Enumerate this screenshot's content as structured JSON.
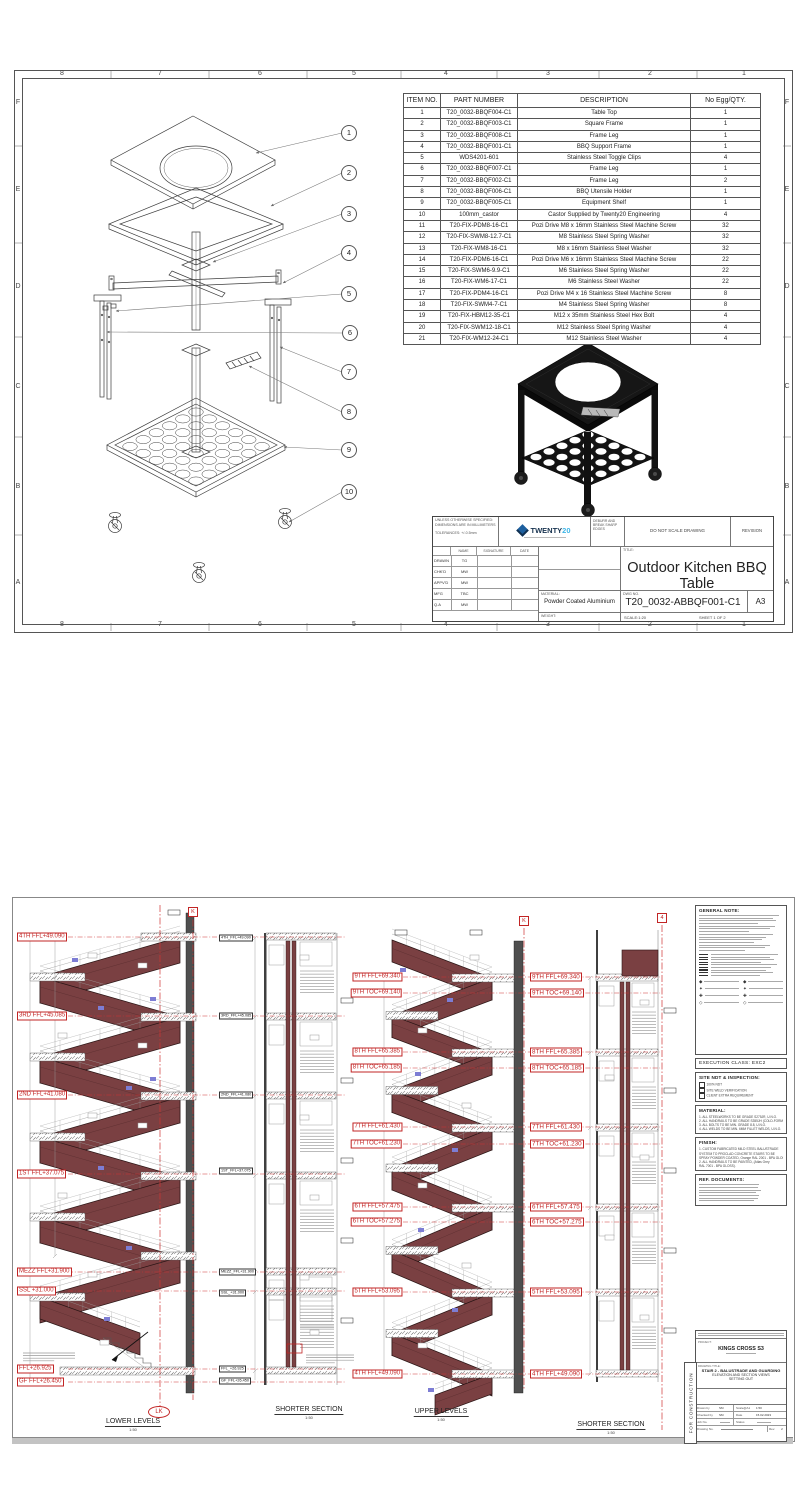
{
  "sheet1": {
    "grid": {
      "cols": [
        "8",
        "7",
        "6",
        "5",
        "4",
        "3",
        "2",
        "1"
      ],
      "rows": [
        "F",
        "E",
        "D",
        "C",
        "B",
        "A"
      ]
    },
    "balloons": [
      "1",
      "2",
      "3",
      "4",
      "5",
      "6",
      "7",
      "8",
      "9",
      "10"
    ],
    "parts_table": {
      "headers": [
        "ITEM NO.",
        "PART NUMBER",
        "DESCRIPTION",
        "No Egg/QTY."
      ],
      "rows": [
        [
          "1",
          "T20_0032-BBQF004-C1",
          "Table Top",
          "1"
        ],
        [
          "2",
          "T20_0032-BBQF003-C1",
          "Square Frame",
          "1"
        ],
        [
          "3",
          "T20_0032-BBQF008-C1",
          "Frame Leg",
          "1"
        ],
        [
          "4",
          "T20_0032-BBQF001-C1",
          "BBQ Support Frame",
          "1"
        ],
        [
          "5",
          "WDS4201-601",
          "Stainless Steel Toggle Clips",
          "4"
        ],
        [
          "6",
          "T20_0032-BBQF007-C1",
          "Frame Leg",
          "1"
        ],
        [
          "7",
          "T20_0032-BBQF002-C1",
          "Frame Leg",
          "2"
        ],
        [
          "8",
          "T20_0032-BBQF006-C1",
          "BBQ Utensile Holder",
          "1"
        ],
        [
          "9",
          "T20_0032-BBQF005-C1",
          "Equipment Shelf",
          "1"
        ],
        [
          "10",
          "100mm_castor",
          "Castor Supplied by Twenty20 Engineering",
          "4"
        ],
        [
          "11",
          "T20-FIX-PDM8-16-C1",
          "Pozi Drive M8 x 16mm Stainless Steel Machine Screw",
          "32"
        ],
        [
          "12",
          "T20-FIX-SWM8-12.7-C1",
          "M8 Stainless Steel Spring Washer",
          "32"
        ],
        [
          "13",
          "T20-FIX-WM8-16-C1",
          "M8 x 16mm Stainless Steel Washer",
          "32"
        ],
        [
          "14",
          "T20-FIX-PDM6-16-C1",
          "Pozi Drive M6 x 16mm Stainless Steel Machine Screw",
          "22"
        ],
        [
          "15",
          "T20-FIX-SWM6-9.9-C1",
          "M6 Stainless Steel Spring Washer",
          "22"
        ],
        [
          "16",
          "T20-FIX-WM6-17-C1",
          "M6 Stainless Steel Washer",
          "22"
        ],
        [
          "17",
          "T20-FIX-PDM4-16-C1",
          "Pozi Drive M4 x 16 Stainless Steel Machine Screw",
          "8"
        ],
        [
          "18",
          "T20-FIX-SWM4-7-C1",
          "M4 Stainless Steel Spring Washer",
          "8"
        ],
        [
          "19",
          "T20-FIX-HBM12-35-C1",
          "M12 x 35mm Stainless Steel Hex Bolt",
          "4"
        ],
        [
          "20",
          "T20-FIX-SWM12-18-C1",
          "M12 Stainless Steel Spring Washer",
          "4"
        ],
        [
          "21",
          "T20-FIX-WM12-24-C1",
          "M12 Stainless Steel Washer",
          "4"
        ]
      ]
    },
    "title_block": {
      "tol1": "UNLESS OTHERWISE SPECIFIED:",
      "tol2": "DIMENSIONS ARE IN MILLIMETERS",
      "tol3": "TOLERANCES: +/-0.5mm",
      "logo_a": "TWENTY",
      "logo_b": "20",
      "deburr": "DEBURR AND BREAK SHARP EDGES",
      "do_not_scale": "DO NOT SCALE DRAWING",
      "revision": "REVISION",
      "sign_headers": [
        "NAME",
        "SIGNATURE",
        "DATE"
      ],
      "sign_rows": [
        [
          "DRAWN",
          "TG"
        ],
        [
          "CHK'D",
          "MW"
        ],
        [
          "APPV'D",
          "MW"
        ],
        [
          "MFG",
          "TBC"
        ],
        [
          "Q.A",
          "MW"
        ]
      ],
      "material_label": "MATERIAL:",
      "material": "Powder Coated Aluminium",
      "weight_label": "WEIGHT:",
      "title_label": "TITLE:",
      "title1": "Outdoor Kitchen BBQ",
      "title2": "Table",
      "dwg_label": "DWG NO.",
      "dwg_no": "T20_0032-ABBQF001-C1",
      "size": "A3",
      "scale": "SCALE:1:20",
      "sheet": "SHEET 1 OF 2"
    }
  },
  "sheet2": {
    "levels_left": [
      "4TH FFL+49.090",
      "3RD FFL+45.085",
      "2ND FFL+41.080",
      "1ST FFL+37.075",
      "MEZZ FFL+31.900",
      "SSL +31.000",
      "FFL+26.925",
      "GF FFL+26.450"
    ],
    "levels_small": [
      "4TH_FFL+49.090",
      "3RD_FFL+45.085",
      "2ND_FFL+41.080",
      "1ST_FFL+37.075",
      "MEZZ_FFL+31.900",
      "SSL_+31.000",
      "FFL_+26.925",
      "GF_FFL+26.450"
    ],
    "levels_upper": [
      "9TH FFL+69.340",
      "9TH TOC+69.140",
      "8TH FFL+65.385",
      "8TH TOC+65.185",
      "7TH FFL+61.430",
      "7TH TOC+61.230",
      "6TH FFL+57.475",
      "6TH TOC+57.275",
      "5TH FFL+53.095",
      "4TH FFL+49.090"
    ],
    "markers": {
      "k1": "K",
      "k2": "K",
      "four": "4",
      "lk": "LK"
    },
    "section_titles": [
      {
        "label": "LOWER LEVELS",
        "scale": "1:50"
      },
      {
        "label": "SHORTER SECTION",
        "scale": "1:50"
      },
      {
        "label": "UPPER LEVELS",
        "scale": "1:50"
      },
      {
        "label": "SHORTER SECTION",
        "scale": "1:50"
      }
    ],
    "notes": {
      "general_title": "GENERAL NOTE:",
      "execution": "EXECUTION CLASS:  EXC2",
      "ndt_title": "SITE NDT & INSPECTION:",
      "ndt_items": [
        "100% NDT",
        "SITE WELD VERIFICATION",
        "CLIENT EXTRA REQUIREMENT"
      ],
      "material_title": "MATERIAL:",
      "material_items": [
        "1. ALL STEELWORKS TO BE GRADE S275JR, U.N.O.",
        "2. ALL HANDRAILS TO BE GRADE S355JH (COLD-FORMED)",
        "3. ALL BOLTS TO BE MIN. GRADE 8.8, U.N.O.",
        "4. ALL WELDS TO BE MIN. 6MM FILLET WELDS, U.N.O."
      ],
      "finish_title": "FINISH:",
      "finish_items": [
        "1. CUSTOM FABRICATED MILD STEEL BALUSTRADE",
        "SYSTEM TO PROCLAD CONCRETE STAIRS TO BE",
        "SPRAY POWDER COATED, Orange RAL 2001 - BPA GLOSS.",
        "2. ALL HANDRAILS TO BE PAINTED, (Atlas Grey",
        "RAL 7001 - BPA GLOSS)."
      ],
      "ref_title": "REF. DOCUMENTS:"
    },
    "title_block": {
      "project_label": "PROJECT:",
      "project": "KINGS CROSS S3",
      "drawing_title_label": "DRAWING TITLE:",
      "t1": "STAIR 2 - BALUSTRADE AND GUARDING",
      "t2": "ELEVATION AND SECTION VIEWS",
      "t3": "SETTING OUT",
      "for_construction": "FOR CONSTRUCTION",
      "f_drawn_label": "Drawn by",
      "f_drawn": "SM",
      "f_scale_label": "Scale@A1",
      "f_scale": "1:50",
      "f_checked_label": "Checked by",
      "f_checked": "SM",
      "f_date_label": "Date",
      "f_date": "15.02.2023",
      "f_job_label": "Job No.",
      "f_status_label": "Status",
      "f_dwg_label": "Drawing No.",
      "f_rev_label": "Rev.",
      "f_rev": "2"
    }
  }
}
